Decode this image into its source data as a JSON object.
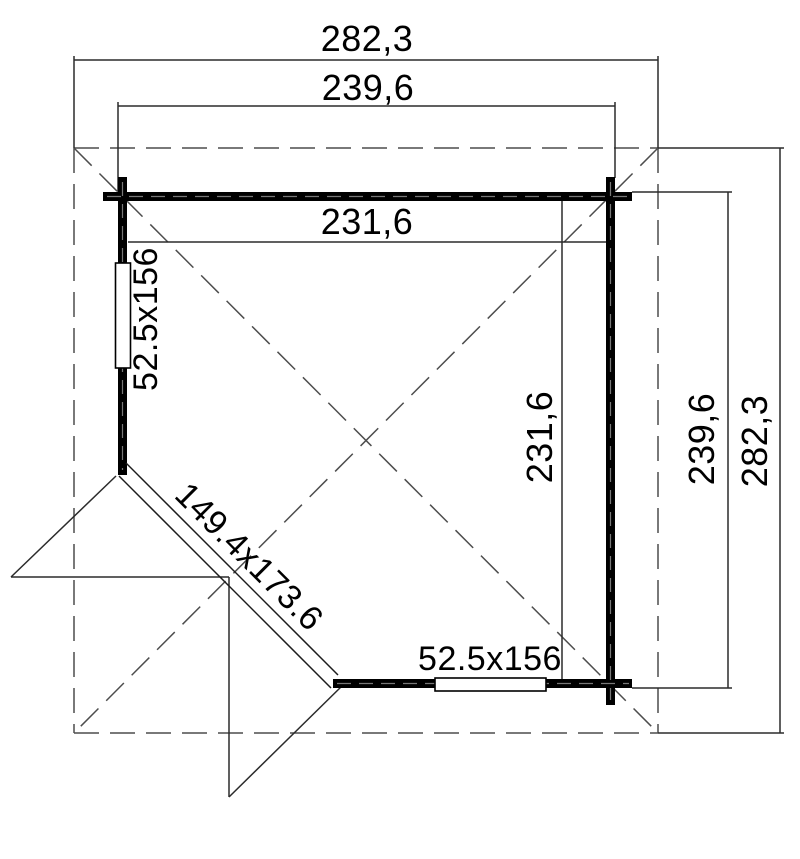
{
  "drawing": {
    "type": "floor-plan",
    "background": "#ffffff",
    "colors": {
      "wall": "#000000",
      "thin_line": "#2b2b2b",
      "dashed_roof_line": "#4d4d4d",
      "wall_centerline": "#787878",
      "window_fill": "#ffffff",
      "text": "#000000"
    },
    "labels": {
      "roof_width_top": "282,3",
      "wall_width_top": "239,6",
      "inner_width_top": "231,6",
      "inner_depth_right": "231,6",
      "wall_depth_right": "239,6",
      "roof_depth_right": "282,3",
      "left_window": "52.5x156",
      "bottom_window": "52.5x156",
      "corner_door": "149.4x173.6"
    }
  }
}
